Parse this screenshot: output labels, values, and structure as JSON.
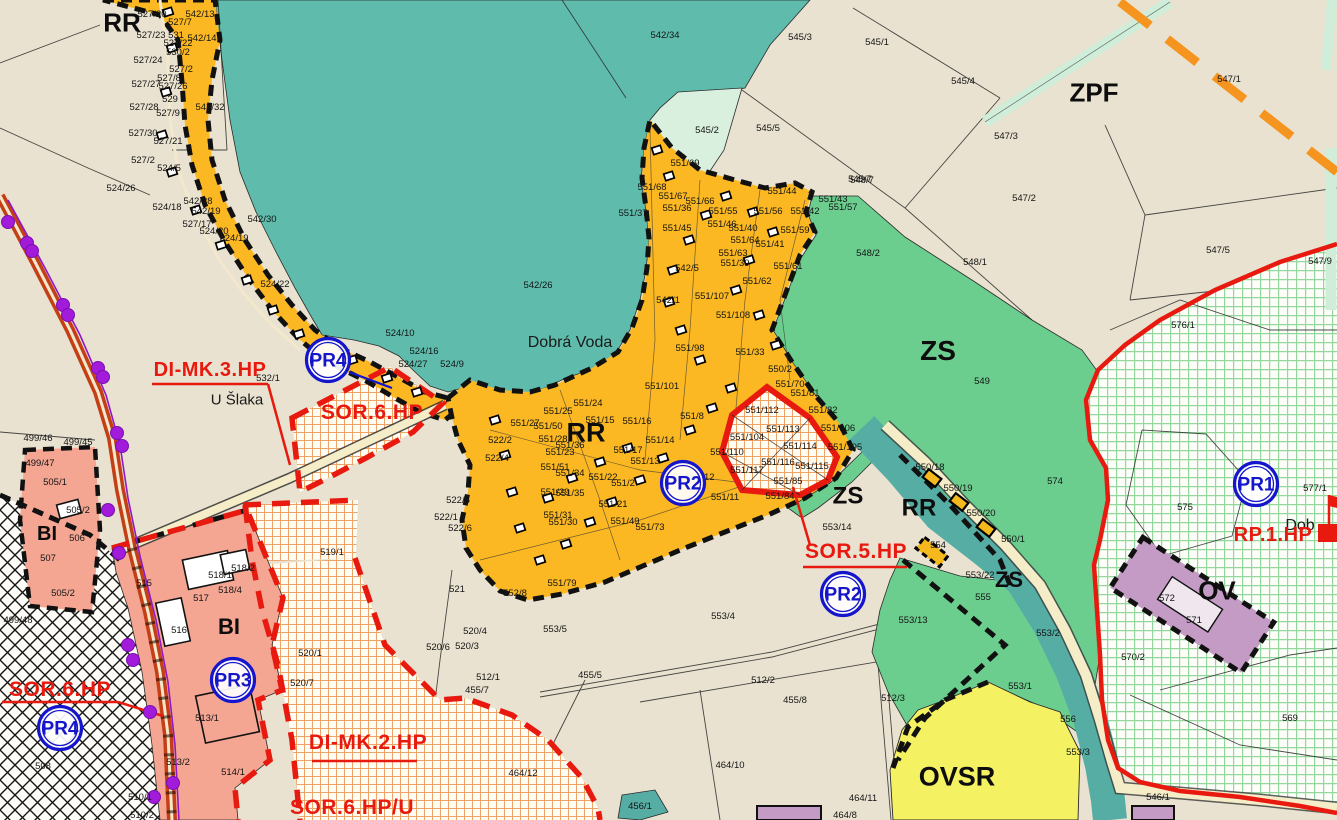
{
  "colors": {
    "background": "#E9E2D0",
    "forest_teal": "#5FBCAC",
    "chata_orange": "#FBB822",
    "zs_green": "#6CCE8E",
    "pale_green": "#D9F0DE",
    "grid_green_line": "#93D79C",
    "bi_pink": "#F4A693",
    "ovsr_yellow": "#F4F163",
    "ov_purple": "#C39BC4",
    "plan_red": "#E8190F",
    "marker_blue": "#1515CC",
    "corridor_orange": "#F5941E",
    "hatch_orange": "#EFA365",
    "road_brown": "#C43E16",
    "utility_purple": "#A21BDB"
  },
  "map": {
    "zone_labels": [
      {
        "text": "RR",
        "x": 122,
        "y": 22,
        "size": 26
      },
      {
        "text": "RR",
        "x": 586,
        "y": 432,
        "size": 27
      },
      {
        "text": "RR",
        "x": 919,
        "y": 507,
        "size": 24
      },
      {
        "text": "ZS",
        "x": 938,
        "y": 350,
        "size": 28
      },
      {
        "text": "ZS",
        "x": 848,
        "y": 495,
        "size": 24
      },
      {
        "text": "ZS",
        "x": 1009,
        "y": 579,
        "size": 22
      },
      {
        "text": "ZPF",
        "x": 1094,
        "y": 92,
        "size": 26
      },
      {
        "text": "BI",
        "x": 47,
        "y": 533,
        "size": 20
      },
      {
        "text": "BI",
        "x": 229,
        "y": 626,
        "size": 22
      },
      {
        "text": "OV",
        "x": 1217,
        "y": 590,
        "size": 26
      },
      {
        "text": "OVSR",
        "x": 957,
        "y": 776,
        "size": 27
      }
    ],
    "place_labels": [
      {
        "text": "Dobrá Voda",
        "x": 570,
        "y": 341,
        "size": 16
      },
      {
        "text": "U Šlaka",
        "x": 237,
        "y": 399,
        "size": 15
      },
      {
        "text": "Dob",
        "x": 1300,
        "y": 524,
        "size": 16
      }
    ],
    "plan_labels": [
      {
        "text": "DI-MK.3.HP",
        "x": 210,
        "y": 376,
        "size": 20
      },
      {
        "text": "SOR.6.HP",
        "x": 372,
        "y": 419,
        "size": 21
      },
      {
        "text": "SOR.5.HP",
        "x": 856,
        "y": 558,
        "size": 21
      },
      {
        "text": "SOR.6.HP",
        "x": 60,
        "y": 696,
        "size": 21
      },
      {
        "text": "DI-MK.2.HP",
        "x": 368,
        "y": 749,
        "size": 21
      },
      {
        "text": "SOR.6.HP/U",
        "x": 352,
        "y": 814,
        "size": 21
      },
      {
        "text": "RP.1.HP",
        "x": 1273,
        "y": 541,
        "size": 20
      }
    ],
    "pr_markers": [
      {
        "text": "PR4",
        "x": 328,
        "y": 360
      },
      {
        "text": "PR2",
        "x": 683,
        "y": 483
      },
      {
        "text": "PR2",
        "x": 843,
        "y": 594
      },
      {
        "text": "PR3",
        "x": 233,
        "y": 680
      },
      {
        "text": "PR4",
        "x": 60,
        "y": 728
      },
      {
        "text": "PR1",
        "x": 1256,
        "y": 484
      }
    ],
    "parcel_labels": [
      [
        "527/20",
        152,
        14
      ],
      [
        "542/13",
        200,
        14
      ],
      [
        "527/7",
        180,
        22
      ],
      [
        "527/23",
        151,
        35
      ],
      [
        "531",
        176,
        35
      ],
      [
        "542/14",
        202,
        38
      ],
      [
        "527/22",
        178,
        43
      ],
      [
        "530/2",
        178,
        52
      ],
      [
        "527/24",
        148,
        60
      ],
      [
        "527/2",
        181,
        69
      ],
      [
        "527/8",
        169,
        78
      ],
      [
        "527/27",
        146,
        84
      ],
      [
        "527/26",
        173,
        86
      ],
      [
        "529",
        170,
        99
      ],
      [
        "527/28",
        144,
        107
      ],
      [
        "542/32",
        210,
        107
      ],
      [
        "527/9",
        168,
        113
      ],
      [
        "527/30",
        143,
        133
      ],
      [
        "527/21",
        168,
        141
      ],
      [
        "527/2",
        143,
        160
      ],
      [
        "524/5",
        169,
        168
      ],
      [
        "524/26",
        121,
        188
      ],
      [
        "524/18",
        167,
        207
      ],
      [
        "542/28",
        198,
        201
      ],
      [
        "542/19",
        206,
        211
      ],
      [
        "527/17",
        197,
        224
      ],
      [
        "524/20",
        214,
        231
      ],
      [
        "524/19",
        234,
        238
      ],
      [
        "542/30",
        262,
        219
      ],
      [
        "524/22",
        275,
        284
      ],
      [
        "542/26",
        538,
        285
      ],
      [
        "524/10",
        400,
        333
      ],
      [
        "524/16",
        424,
        351
      ],
      [
        "524/27",
        413,
        364
      ],
      [
        "524/9",
        452,
        364
      ],
      [
        "542/34",
        665,
        35
      ],
      [
        "545/3",
        800,
        37
      ],
      [
        "545/1",
        877,
        42
      ],
      [
        "545/4",
        963,
        81
      ],
      [
        "545/5",
        768,
        128
      ],
      [
        "545/2",
        707,
        130
      ],
      [
        "545/7",
        860,
        179
      ],
      [
        "547/3",
        1006,
        136
      ],
      [
        "547/1",
        1229,
        79
      ],
      [
        "547/2",
        1024,
        198
      ],
      [
        "547/5",
        1218,
        250
      ],
      [
        "547/9",
        1320,
        261
      ],
      [
        "548/7",
        862,
        180
      ],
      [
        "548/2",
        868,
        253
      ],
      [
        "548/1",
        975,
        262
      ],
      [
        "576/1",
        1183,
        325
      ],
      [
        "542/1",
        668,
        300
      ],
      [
        "542/5",
        687,
        268
      ],
      [
        "551/69",
        685,
        163
      ],
      [
        "551/68",
        652,
        187
      ],
      [
        "551/67",
        673,
        196
      ],
      [
        "551/66",
        700,
        201
      ],
      [
        "551/36",
        677,
        208
      ],
      [
        "551/37",
        633,
        213
      ],
      [
        "551/45",
        677,
        228
      ],
      [
        "551/55",
        723,
        211
      ],
      [
        "551/44",
        782,
        191
      ],
      [
        "551/56",
        768,
        211
      ],
      [
        "551/42",
        805,
        211
      ],
      [
        "551/43",
        833,
        199
      ],
      [
        "551/57",
        843,
        207
      ],
      [
        "551/59",
        795,
        230
      ],
      [
        "551/46",
        722,
        224
      ],
      [
        "551/40",
        743,
        228
      ],
      [
        "551/64",
        745,
        240
      ],
      [
        "551/41",
        770,
        244
      ],
      [
        "551/63",
        733,
        253
      ],
      [
        "551/39",
        735,
        263
      ],
      [
        "551/62",
        757,
        281
      ],
      [
        "551/61",
        788,
        266
      ],
      [
        "551/107",
        712,
        296
      ],
      [
        "551/108",
        733,
        315
      ],
      [
        "551/98",
        690,
        348
      ],
      [
        "551/33",
        750,
        352
      ],
      [
        "551/101",
        662,
        386
      ],
      [
        "550/2",
        780,
        369
      ],
      [
        "551/70",
        790,
        384
      ],
      [
        "551/81",
        805,
        393
      ],
      [
        "551/82",
        823,
        410
      ],
      [
        "551/106",
        838,
        428
      ],
      [
        "551/105",
        845,
        447
      ],
      [
        "551/8",
        692,
        416
      ],
      [
        "551/24",
        588,
        403
      ],
      [
        "551/25",
        558,
        411
      ],
      [
        "551/15",
        600,
        420
      ],
      [
        "551/16",
        637,
        421
      ],
      [
        "551/27",
        525,
        423
      ],
      [
        "551/50",
        548,
        426
      ],
      [
        "551/28",
        553,
        439
      ],
      [
        "551/36",
        570,
        445
      ],
      [
        "551/17",
        628,
        450
      ],
      [
        "551/14",
        660,
        440
      ],
      [
        "551/23",
        560,
        452
      ],
      [
        "551/13",
        645,
        461
      ],
      [
        "551/12",
        700,
        477
      ],
      [
        "551/51",
        555,
        467
      ],
      [
        "551/34",
        570,
        473
      ],
      [
        "551/22",
        603,
        477
      ],
      [
        "551/2",
        623,
        483
      ],
      [
        "551/29",
        555,
        492
      ],
      [
        "551/35",
        570,
        493
      ],
      [
        "551/21",
        613,
        504
      ],
      [
        "551/31",
        558,
        515
      ],
      [
        "551/30",
        563,
        522
      ],
      [
        "551/49",
        625,
        521
      ],
      [
        "551/73",
        650,
        527
      ],
      [
        "551/79",
        562,
        583
      ],
      [
        "552/8",
        515,
        593
      ],
      [
        "551/11",
        725,
        497
      ],
      [
        "551/84",
        780,
        496
      ],
      [
        "551/112",
        762,
        410
      ],
      [
        "551/113",
        783,
        429
      ],
      [
        "551/104",
        747,
        437
      ],
      [
        "551/110",
        727,
        452
      ],
      [
        "551/114",
        800,
        446
      ],
      [
        "551/116",
        778,
        462
      ],
      [
        "551/117",
        747,
        470
      ],
      [
        "551/115",
        812,
        466
      ],
      [
        "551/85",
        788,
        481
      ],
      [
        "532/1",
        268,
        378
      ],
      [
        "522/2",
        500,
        440
      ],
      [
        "522/4",
        497,
        458
      ],
      [
        "522/5",
        458,
        500
      ],
      [
        "522/1",
        446,
        517
      ],
      [
        "522/6",
        460,
        528
      ],
      [
        "519/1",
        332,
        552
      ],
      [
        "521",
        457,
        589
      ],
      [
        "520/4",
        475,
        631
      ],
      [
        "520/6",
        438,
        647
      ],
      [
        "520/3",
        467,
        646
      ],
      [
        "520/7",
        302,
        683
      ],
      [
        "520/1",
        310,
        653
      ],
      [
        "499/46",
        38,
        438
      ],
      [
        "499/45",
        78,
        442
      ],
      [
        "499/47",
        40,
        463
      ],
      [
        "505/1",
        55,
        482
      ],
      [
        "505/2",
        78,
        510
      ],
      [
        "506",
        77,
        538
      ],
      [
        "507",
        48,
        558
      ],
      [
        "505/2",
        63,
        593
      ],
      [
        "499/48",
        18,
        620
      ],
      [
        "508",
        43,
        766
      ],
      [
        "515",
        144,
        583
      ],
      [
        "517",
        201,
        598
      ],
      [
        "518/1",
        220,
        575
      ],
      [
        "518/2",
        243,
        568
      ],
      [
        "518/4",
        230,
        590
      ],
      [
        "516",
        179,
        630
      ],
      [
        "513/1",
        207,
        718
      ],
      [
        "513/2",
        178,
        762
      ],
      [
        "514/1",
        233,
        772
      ],
      [
        "510/1",
        140,
        797
      ],
      [
        "510/2",
        142,
        815
      ],
      [
        "553/5",
        555,
        629
      ],
      [
        "455/5",
        590,
        675
      ],
      [
        "455/7",
        477,
        690
      ],
      [
        "512/1",
        488,
        677
      ],
      [
        "512/2",
        763,
        680
      ],
      [
        "455/8",
        795,
        700
      ],
      [
        "464/12",
        523,
        773
      ],
      [
        "464/10",
        730,
        765
      ],
      [
        "464/11",
        863,
        798
      ],
      [
        "464/8",
        845,
        815
      ],
      [
        "553/14",
        837,
        527
      ],
      [
        "553/4",
        723,
        616
      ],
      [
        "553/13",
        913,
        620
      ],
      [
        "456/1",
        640,
        806
      ],
      [
        "549",
        982,
        381
      ],
      [
        "574",
        1055,
        481
      ],
      [
        "550/18",
        930,
        467
      ],
      [
        "550/19",
        958,
        488
      ],
      [
        "550/20",
        981,
        513
      ],
      [
        "550/1",
        1013,
        539
      ],
      [
        "554",
        938,
        545
      ],
      [
        "553/22",
        980,
        575
      ],
      [
        "555",
        983,
        597
      ],
      [
        "553/2",
        1048,
        633
      ],
      [
        "553/1",
        1020,
        686
      ],
      [
        "556",
        1068,
        719
      ],
      [
        "512/3",
        893,
        698
      ],
      [
        "553/3",
        1078,
        752
      ],
      [
        "546/1",
        1158,
        797
      ],
      [
        "575",
        1185,
        507
      ],
      [
        "577/1",
        1315,
        488
      ],
      [
        "570/2",
        1133,
        657
      ],
      [
        "569",
        1290,
        718
      ],
      [
        "572",
        1167,
        598
      ],
      [
        "571",
        1194,
        620
      ]
    ],
    "icons": {
      "cottages": [
        [
          168,
          12
        ],
        [
          172,
          48
        ],
        [
          166,
          92
        ],
        [
          162,
          135
        ],
        [
          172,
          172
        ],
        [
          196,
          210
        ],
        [
          221,
          245
        ],
        [
          247,
          280
        ],
        [
          273,
          310
        ],
        [
          299,
          334
        ],
        [
          352,
          360
        ],
        [
          387,
          378
        ],
        [
          417,
          392
        ],
        [
          495,
          420
        ],
        [
          505,
          455
        ],
        [
          512,
          492
        ],
        [
          520,
          528
        ],
        [
          540,
          560
        ],
        [
          566,
          544
        ],
        [
          590,
          522
        ],
        [
          612,
          502
        ],
        [
          640,
          480
        ],
        [
          663,
          458
        ],
        [
          628,
          448
        ],
        [
          600,
          462
        ],
        [
          572,
          478
        ],
        [
          548,
          498
        ],
        [
          690,
          430
        ],
        [
          712,
          408
        ],
        [
          731,
          388
        ],
        [
          700,
          360
        ],
        [
          681,
          330
        ],
        [
          669,
          302
        ],
        [
          673,
          270
        ],
        [
          689,
          240
        ],
        [
          706,
          215
        ],
        [
          726,
          196
        ],
        [
          753,
          212
        ],
        [
          773,
          232
        ],
        [
          749,
          260
        ],
        [
          736,
          290
        ],
        [
          759,
          315
        ],
        [
          776,
          345
        ],
        [
          657,
          150
        ],
        [
          669,
          176
        ]
      ],
      "yellow_cabins": [
        [
          932,
          478
        ],
        [
          959,
          502
        ],
        [
          986,
          528
        ]
      ],
      "yellow_cabin_large": [
        932,
        552
      ],
      "utility_dots": [
        [
          8,
          222
        ],
        [
          27,
          243
        ],
        [
          32,
          251
        ],
        [
          63,
          305
        ],
        [
          68,
          315
        ],
        [
          98,
          368
        ],
        [
          103,
          377
        ],
        [
          117,
          433
        ],
        [
          122,
          446
        ],
        [
          108,
          510
        ],
        [
          119,
          553
        ],
        [
          128,
          645
        ],
        [
          133,
          660
        ],
        [
          150,
          712
        ],
        [
          154,
          797
        ],
        [
          173,
          783
        ]
      ]
    }
  }
}
